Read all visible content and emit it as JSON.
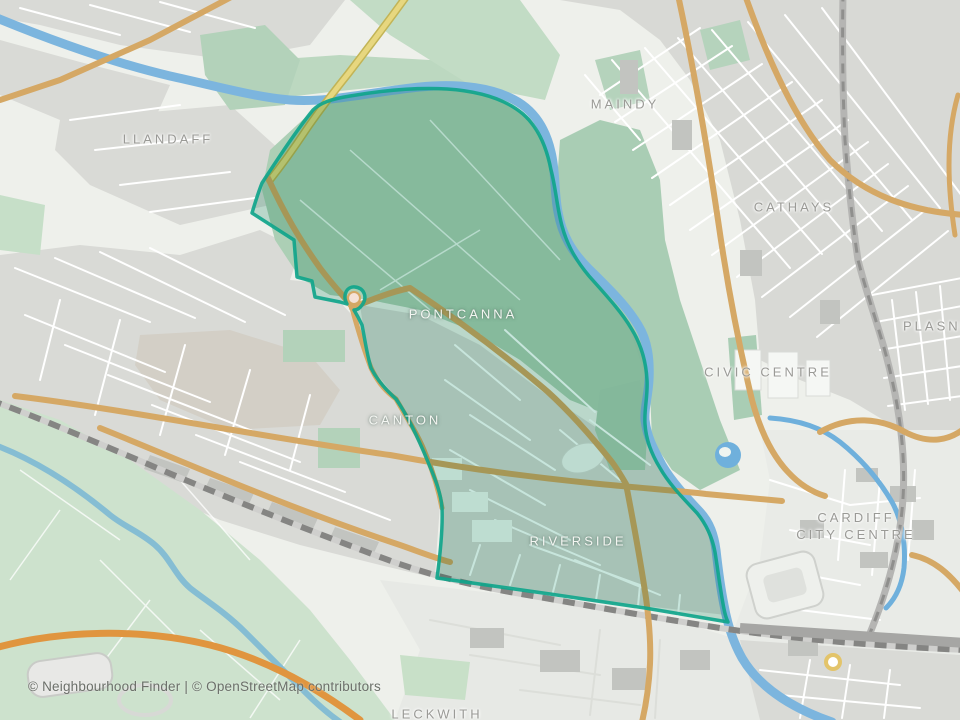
{
  "map": {
    "attribution": "© Neighbourhood Finder | © OpenStreetMap contributors",
    "labels": {
      "llandaff": "LLANDAFF",
      "maindy": "MAINDY",
      "cathays": "CATHAYS",
      "plasnewydd": "PLASNEWYDD",
      "civic_centre": "CIVIC CENTRE",
      "pontcanna": "PONTCANNA",
      "canton": "CANTON",
      "riverside": "RIVERSIDE",
      "cardiff_city_centre": "CARDIFF CITY CENTRE",
      "leckwith": "LECKWITH"
    },
    "highlighted_area": {
      "localities_inside": [
        "PONTCANNA",
        "CANTON",
        "RIVERSIDE"
      ],
      "outline_color": "#10a58b",
      "fill_color": "#2f9e7d"
    },
    "colors": {
      "water": "#7cb5de",
      "canal": "#6fb0dc",
      "river_ely": "#85bdd3",
      "park_green": "#abcfb4",
      "field_green": "#cde2cd",
      "residential_grey": "#d9dad6",
      "road_primary": "#d5a865",
      "road_orange": "#e0953f",
      "road_trunk_yellow": "#e7d77f",
      "railway_grey": "#858583",
      "label_grey": "#9a9a96",
      "label_light": "#f4f6f2"
    }
  }
}
